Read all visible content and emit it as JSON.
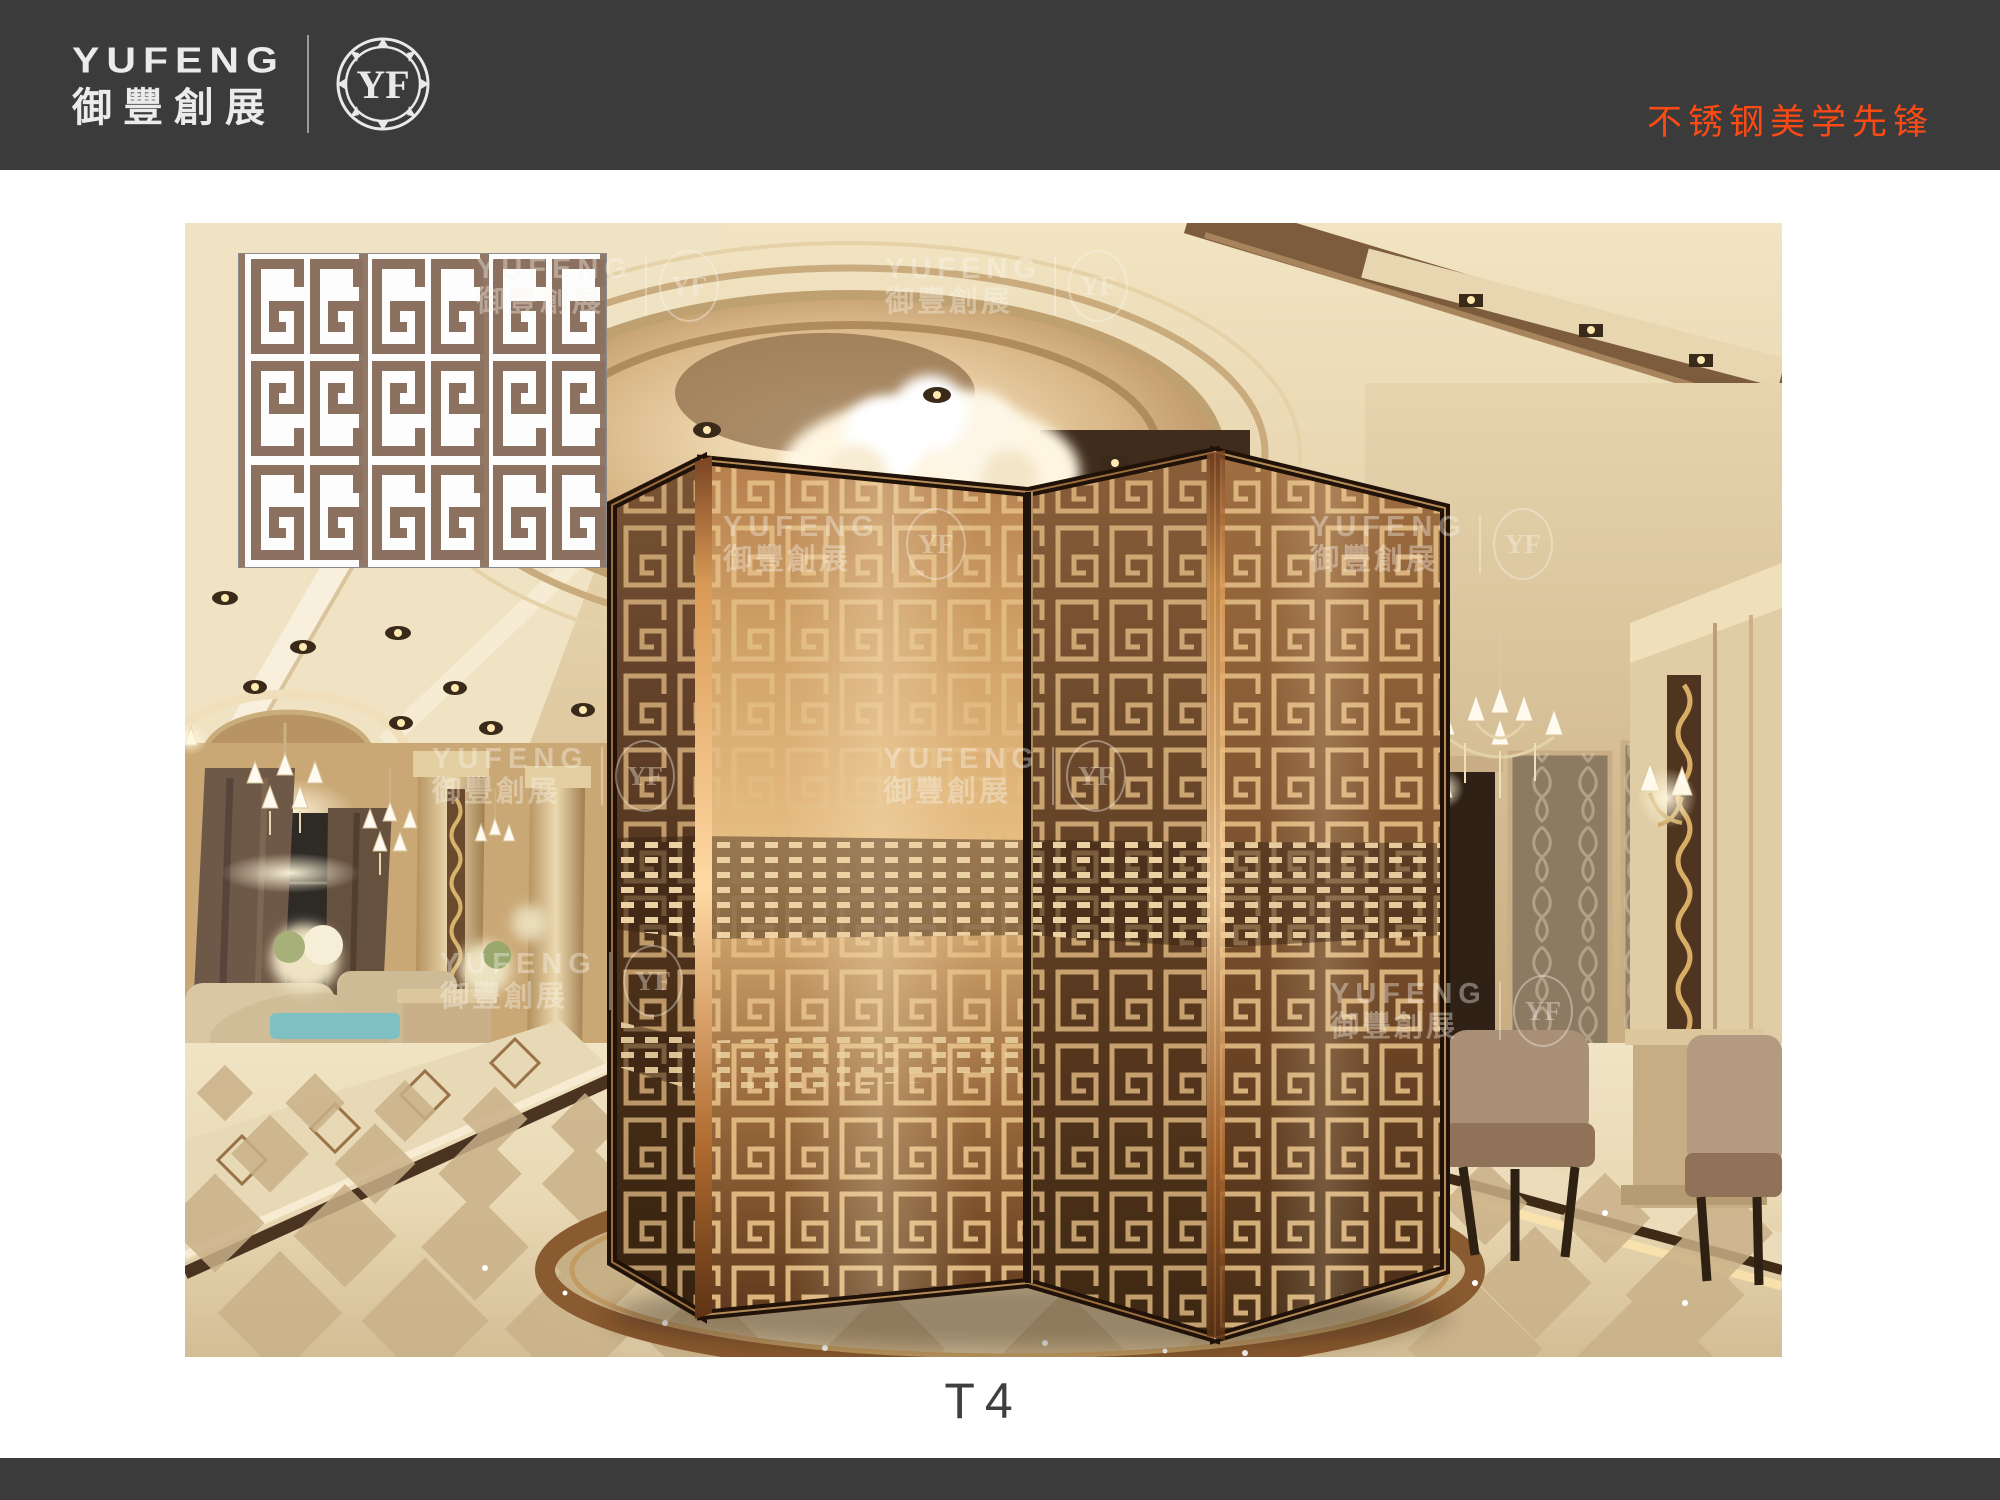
{
  "header": {
    "brand_en": "YUFENG",
    "brand_zh": "御豐創展",
    "badge_text": "YF",
    "slogan": "不锈钢美学先锋"
  },
  "watermark": {
    "en": "YUFENG",
    "zh": "御豐創展",
    "badge": "YF"
  },
  "product": {
    "code": "T4"
  },
  "colors": {
    "header_bg": "#3b3b3b",
    "accent_orange": "#fb4a14",
    "inset_pattern_brown": "#8c7160",
    "bronze_dark": "#553823",
    "bronze_light": "#e3b274",
    "lattice_gold": "#e2bb83"
  }
}
